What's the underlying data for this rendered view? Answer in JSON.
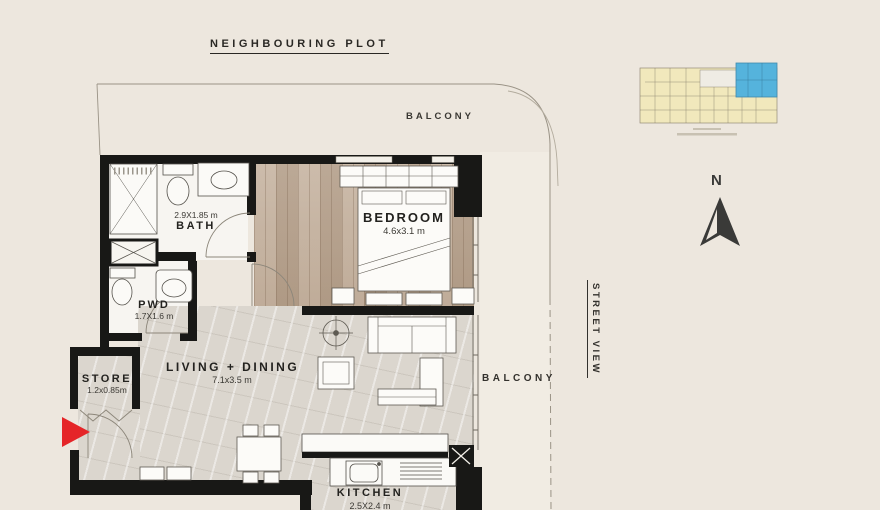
{
  "page": {
    "background": "#EDE7DE"
  },
  "plan": {
    "neighbouring_plot_label": "NEIGHBOURING PLOT",
    "top_balcony_label": "BALCONY",
    "side_balcony_label": "BALCONY",
    "street_view_label": "STREET VIEW",
    "north_label": "N"
  },
  "rooms": {
    "bath": {
      "name": "BATH",
      "dims": "2.9X1.85 m"
    },
    "pwd": {
      "name": "PWD",
      "dims": "1.7X1.6 m"
    },
    "store": {
      "name": "STORE",
      "dims": "1.2x0.85m"
    },
    "living_dining": {
      "name": "LIVING + DINING",
      "dims": "7.1x3.5 m"
    },
    "bedroom": {
      "name": "BEDROOM",
      "dims": "4.6x3.1 m"
    },
    "kitchen": {
      "name": "KITCHEN",
      "dims": "2.5X2.4 m"
    }
  },
  "key_plan": {
    "unit_highlight_color": "#55B3DC",
    "building_color": "#F1E8BC"
  },
  "colors": {
    "wall": "#181816",
    "entry_arrow": "#E52528",
    "wood_floor": "#BFAA95",
    "stone_floor": "#DBD6CE"
  }
}
